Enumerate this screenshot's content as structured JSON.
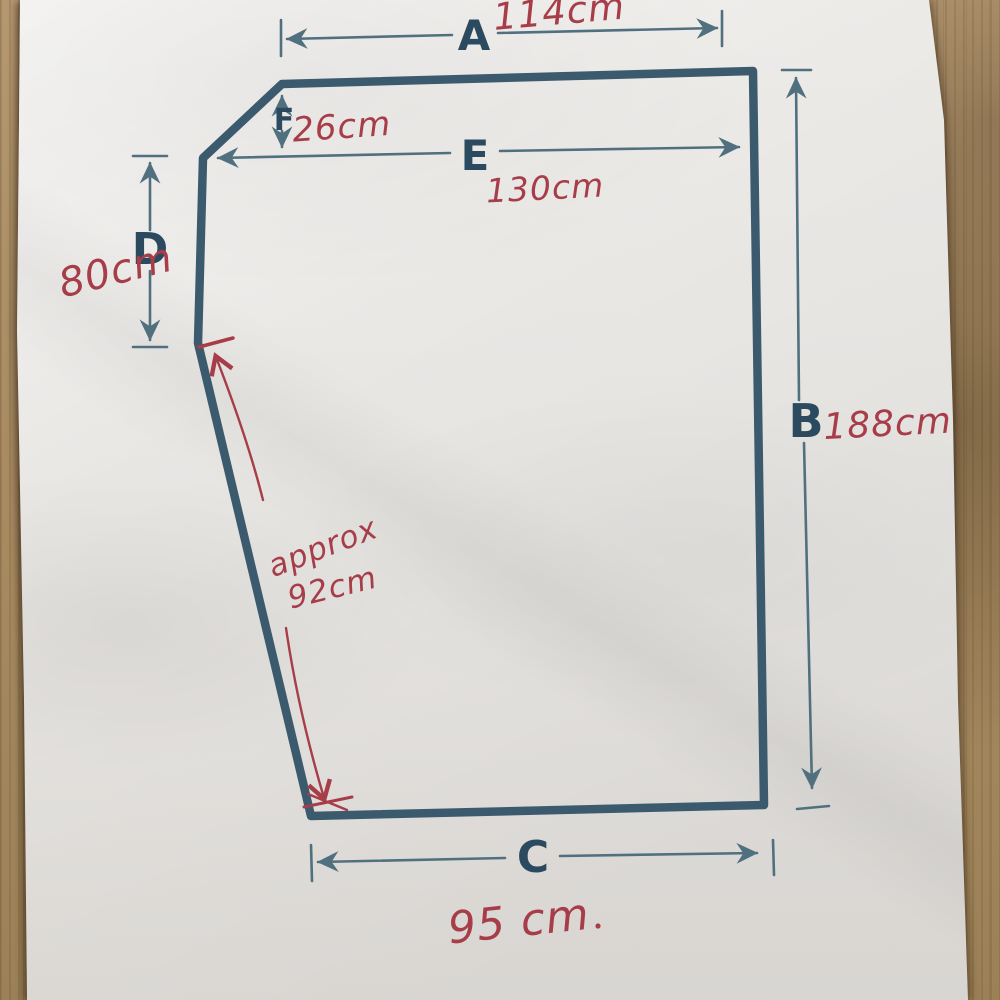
{
  "dims": {
    "A": {
      "label": "A",
      "value": "114cm"
    },
    "B": {
      "label": "B",
      "value": "188cm"
    },
    "C": {
      "label": "C",
      "value": "95 cm"
    },
    "D": {
      "label": "D",
      "value": "80cm"
    },
    "E": {
      "label": "E",
      "value": "130cm"
    },
    "F": {
      "label": "F",
      "value": "26cm"
    }
  },
  "annotation": {
    "word": "approx",
    "value": "92cm"
  },
  "colors": {
    "outline": "#3c5a6d",
    "dimension_lines": "#51707f",
    "letter_labels": "#2b4a5f",
    "ink_red": "#a73d49",
    "paper": "#e8e6e3",
    "wood": "#a98c62"
  }
}
